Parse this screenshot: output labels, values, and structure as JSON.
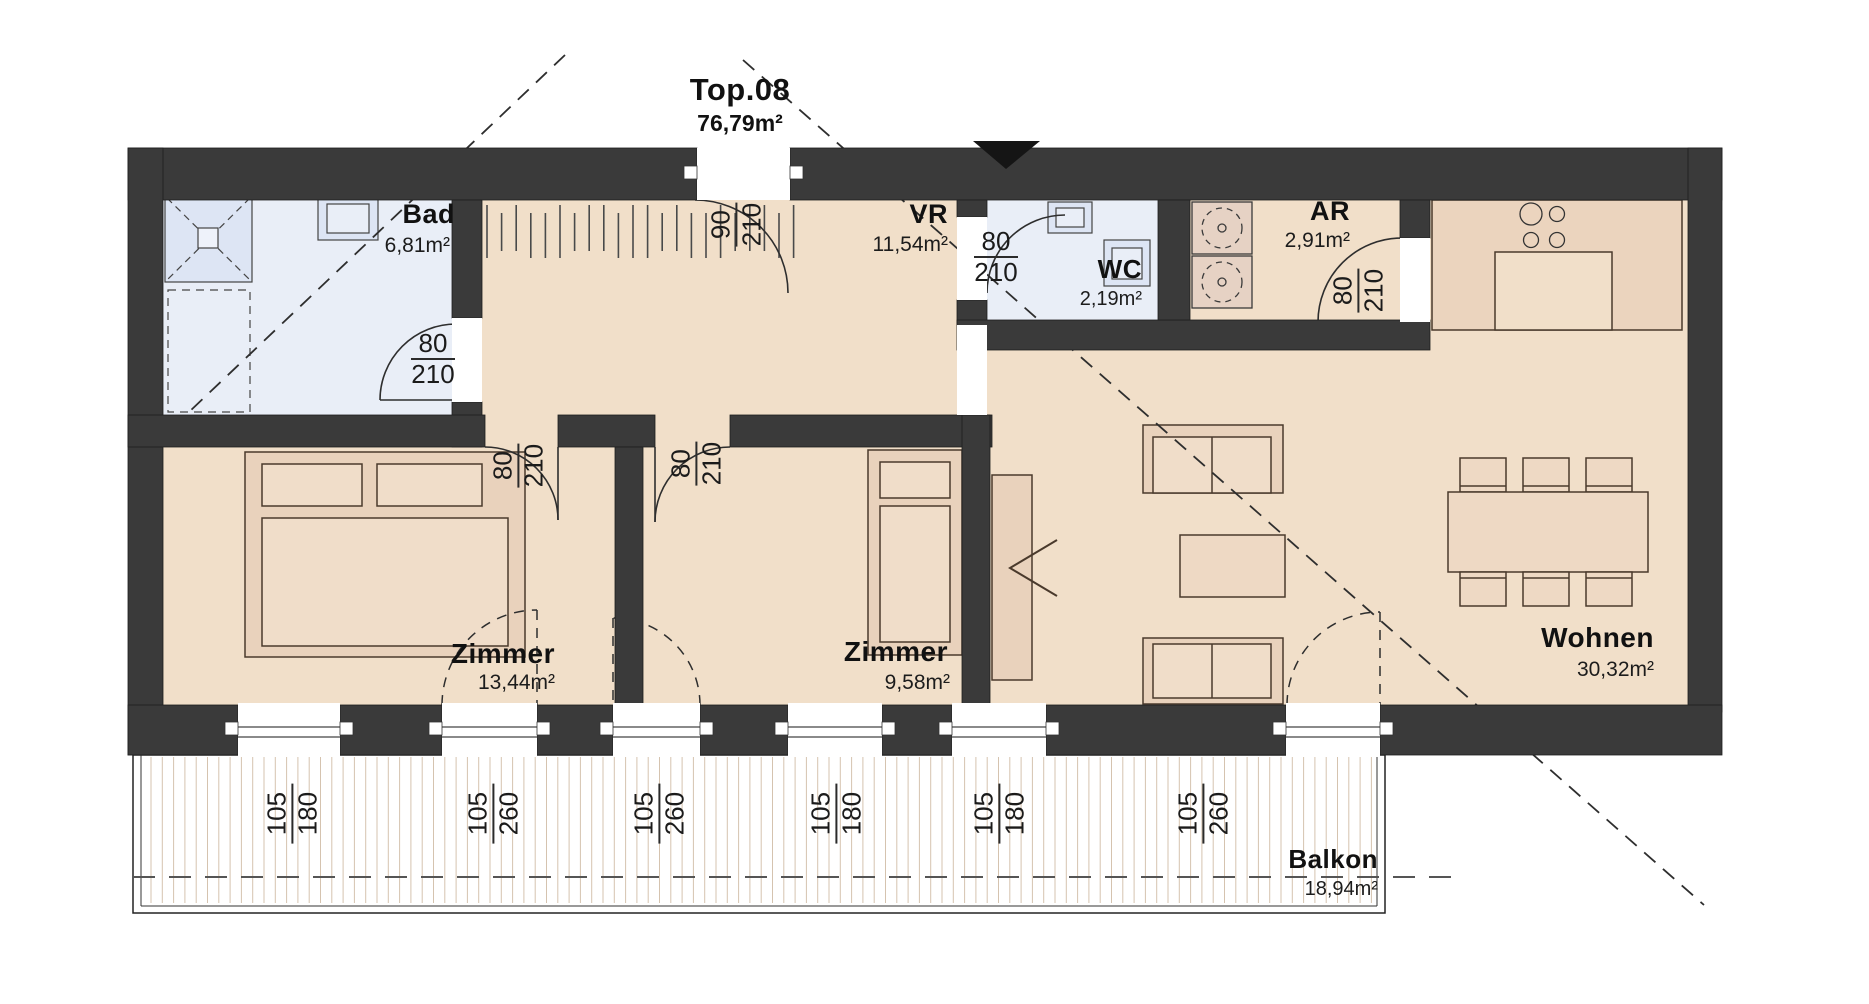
{
  "title": {
    "unit": "Top.08",
    "area": "76,79m²"
  },
  "rooms": {
    "bad": {
      "name": "Bad",
      "area": "6,81m²"
    },
    "vr": {
      "name": "VR",
      "area": "11,54m²"
    },
    "wc": {
      "name": "WC",
      "area": "2,19m²"
    },
    "ar": {
      "name": "AR",
      "area": "2,91m²"
    },
    "zimmer1": {
      "name": "Zimmer",
      "area": "13,44m²"
    },
    "zimmer2": {
      "name": "Zimmer",
      "area": "9,58m²"
    },
    "wohnen": {
      "name": "Wohnen",
      "area": "30,32m²"
    },
    "balkon": {
      "name": "Balkon",
      "area": "18,94m²"
    }
  },
  "doors": {
    "bad": {
      "width": "80",
      "height": "210"
    },
    "entrance": {
      "width": "90",
      "height": "210"
    },
    "wc": {
      "width": "80",
      "height": "210"
    },
    "ar": {
      "width": "80",
      "height": "210"
    },
    "zimmer1": {
      "width": "80",
      "height": "210"
    },
    "zimmer2": {
      "width": "80",
      "height": "210"
    }
  },
  "windows": [
    {
      "width": "105",
      "height": "180"
    },
    {
      "width": "105",
      "height": "260"
    },
    {
      "width": "105",
      "height": "260"
    },
    {
      "width": "105",
      "height": "180"
    },
    {
      "width": "105",
      "height": "180"
    },
    {
      "width": "105",
      "height": "260"
    }
  ],
  "colors": {
    "wall": "#3a3a3a",
    "floor": "#f1dfc9",
    "wetroom": "#e9eef7",
    "kitchen_counter": "#ebd4be",
    "furniture": "#e9d2bc",
    "balcony_hatch": "#d5c3af"
  }
}
